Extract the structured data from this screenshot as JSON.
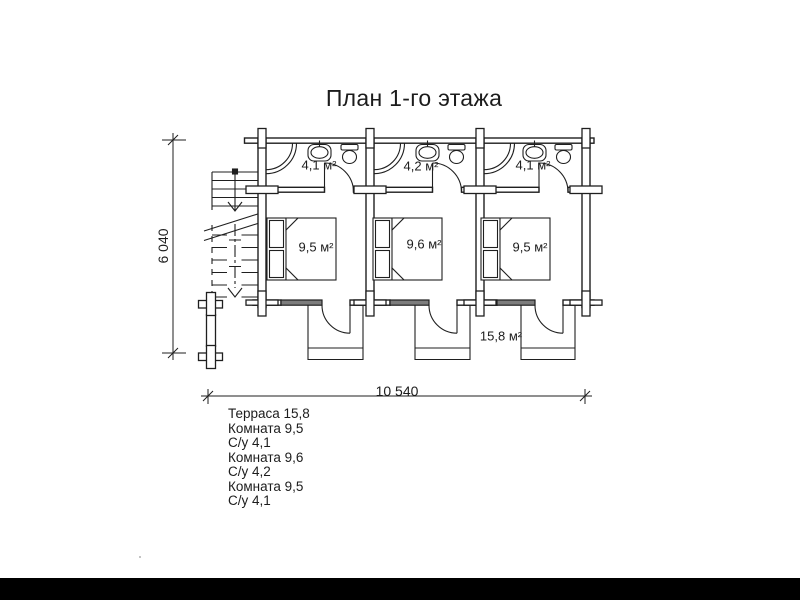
{
  "title": "План 1-го этажа",
  "plan": {
    "bathrooms": [
      {
        "label": "4,1 м²"
      },
      {
        "label": "4,2 м²"
      },
      {
        "label": "4,1 м²"
      }
    ],
    "rooms": [
      {
        "label": "9,5 м²"
      },
      {
        "label": "9,6 м²"
      },
      {
        "label": "9,5 м²"
      }
    ],
    "terrace_label": "15,8 м²"
  },
  "dimensions": {
    "overall_width": "10 540",
    "overall_height": "6 040"
  },
  "legend": {
    "lines": [
      "Терраса 15,8",
      "Комната 9,5",
      "С/у 4,1",
      "Комната 9,6",
      "С/у 4,2",
      "Комната 9,5",
      "С/у 4,1"
    ]
  },
  "colors": {
    "line": "#1f1f1f",
    "background": "#ffffff",
    "window_fill": "#7d7d7d",
    "footer_bar": "#000000"
  }
}
